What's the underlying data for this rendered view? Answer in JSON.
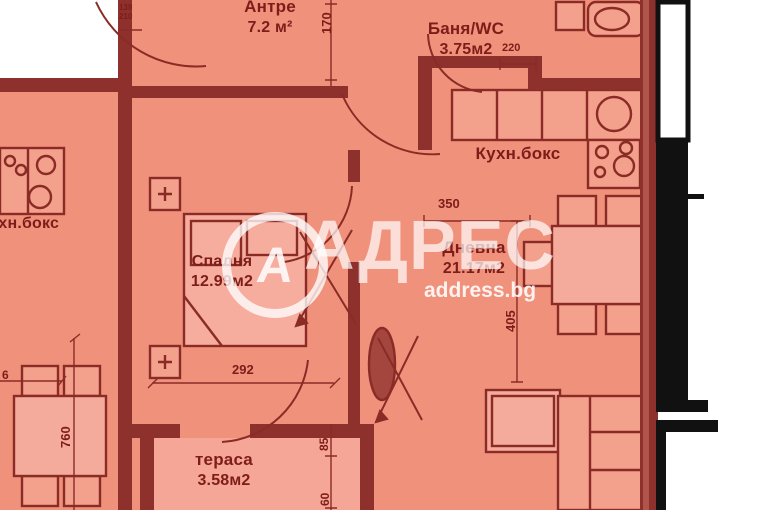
{
  "watermark": {
    "logo_letter": "А",
    "brand": "АДРЕС",
    "site": "address.bg"
  },
  "rooms": {
    "antre": {
      "name": "Антре",
      "area": "7.2 м²"
    },
    "bathroom": {
      "name": "Баня/WC",
      "area": "3.75м2"
    },
    "kitchen": {
      "name": "Кухн.бокс"
    },
    "living": {
      "name": "Дневна",
      "area": "21.17м2"
    },
    "bedroom": {
      "name": "Спалня",
      "area": "12.99м2"
    },
    "terrace": {
      "name": "тераса",
      "area": "3.58м2"
    },
    "neighbor_kitchen": {
      "name": "кухн.бокс"
    }
  },
  "dimensions": {
    "entry_hall_depth": "170",
    "bath_fixture_width": "220",
    "kitchen_width": "350",
    "living_width": "405",
    "bedroom_width": "292",
    "neighbor_table_length": "760",
    "neighbor_edge": "6",
    "terrace_upper": "85",
    "terrace_lower": "60",
    "window_marker_top": "139",
    "window_marker_bottom": "210"
  },
  "colors": {
    "room_fill": "#f0917c",
    "wall": "#8e312c",
    "furniture_fill": "#f3a18c",
    "light_fill": "#f5a696",
    "text": "#7e1c19",
    "outline_black": "#111111"
  }
}
